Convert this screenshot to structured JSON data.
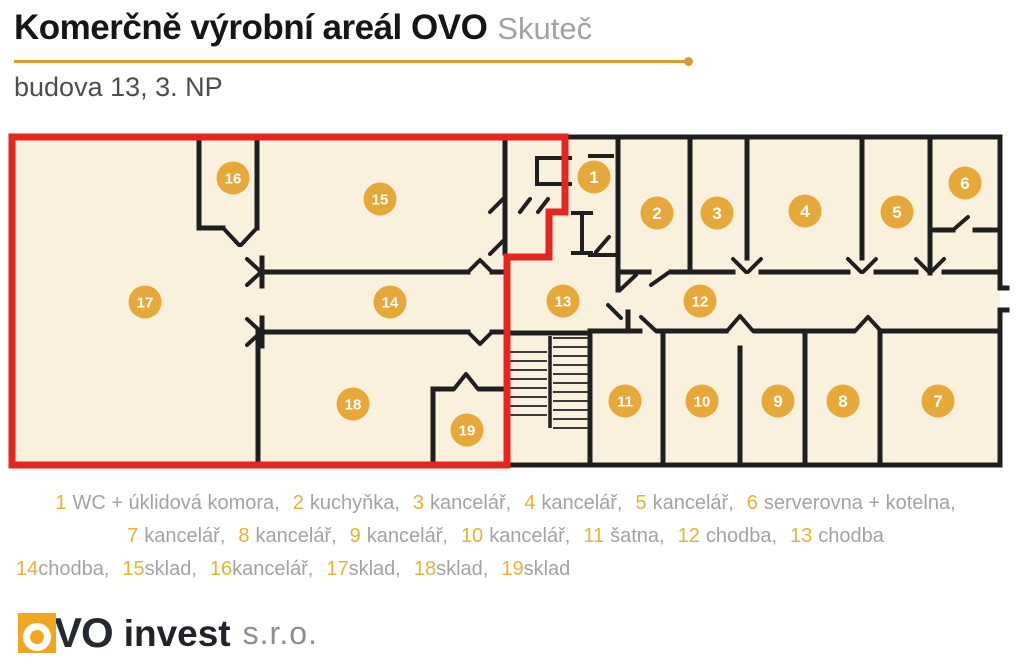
{
  "header": {
    "title": "Komerčně výrobní areál OVO",
    "city": "Skuteč",
    "floor": "budova 13, 3. NP"
  },
  "colors": {
    "wall": "#1f1f1f",
    "floor_fill": "#f9f1de",
    "highlight_red": "#e52520",
    "badge_orange": "#e7a83a",
    "accent_gold": "#d89c2b",
    "legend_number": "#e8b234",
    "legend_text": "#a3a3a3"
  },
  "plan": {
    "rooms": [
      {
        "n": "1",
        "x": 594,
        "y": 177
      },
      {
        "n": "2",
        "x": 657,
        "y": 213
      },
      {
        "n": "3",
        "x": 717,
        "y": 213
      },
      {
        "n": "4",
        "x": 805,
        "y": 211
      },
      {
        "n": "5",
        "x": 897,
        "y": 212
      },
      {
        "n": "6",
        "x": 965,
        "y": 183
      },
      {
        "n": "7",
        "x": 938,
        "y": 401
      },
      {
        "n": "8",
        "x": 843,
        "y": 401
      },
      {
        "n": "9",
        "x": 778,
        "y": 401
      },
      {
        "n": "10",
        "x": 702,
        "y": 401
      },
      {
        "n": "11",
        "x": 625,
        "y": 401
      },
      {
        "n": "12",
        "x": 700,
        "y": 301
      },
      {
        "n": "13",
        "x": 563,
        "y": 301
      },
      {
        "n": "14",
        "x": 390,
        "y": 302
      },
      {
        "n": "15",
        "x": 380,
        "y": 199
      },
      {
        "n": "16",
        "x": 233,
        "y": 178
      },
      {
        "n": "17",
        "x": 145,
        "y": 302
      },
      {
        "n": "18",
        "x": 353,
        "y": 404
      },
      {
        "n": "19",
        "x": 467,
        "y": 430
      }
    ]
  },
  "legend": {
    "lines": [
      {
        "align": "center",
        "spaced": true,
        "items": [
          {
            "n": "1",
            "label": "WC + úklidová komora,"
          },
          {
            "n": "2",
            "label": "kuchyňka,"
          },
          {
            "n": "3",
            "label": "kancelář,"
          },
          {
            "n": "4",
            "label": "kancelář,"
          },
          {
            "n": "5",
            "label": "kancelář,"
          },
          {
            "n": "6",
            "label": "serverovna + kotelna,"
          }
        ]
      },
      {
        "align": "center",
        "spaced": true,
        "items": [
          {
            "n": "7",
            "label": "kancelář,"
          },
          {
            "n": "8",
            "label": "kancelář,"
          },
          {
            "n": "9",
            "label": "kancelář,"
          },
          {
            "n": "10",
            "label": "kancelář,"
          },
          {
            "n": "11",
            "label": "šatna,"
          },
          {
            "n": "12",
            "label": "chodba,"
          },
          {
            "n": "13",
            "label": "chodba"
          }
        ]
      },
      {
        "align": "left",
        "spaced": false,
        "items": [
          {
            "n": "14",
            "label": "chodba,"
          },
          {
            "n": "15",
            "label": "sklad,"
          },
          {
            "n": "16",
            "label": "kancelář,"
          },
          {
            "n": "17",
            "label": "sklad,"
          },
          {
            "n": "18",
            "label": "sklad,"
          },
          {
            "n": "19",
            "label": "sklad"
          }
        ]
      }
    ]
  },
  "footer": {
    "brand_vo": "VO",
    "brand_invest": "invest",
    "brand_suffix": "s.r.o."
  }
}
